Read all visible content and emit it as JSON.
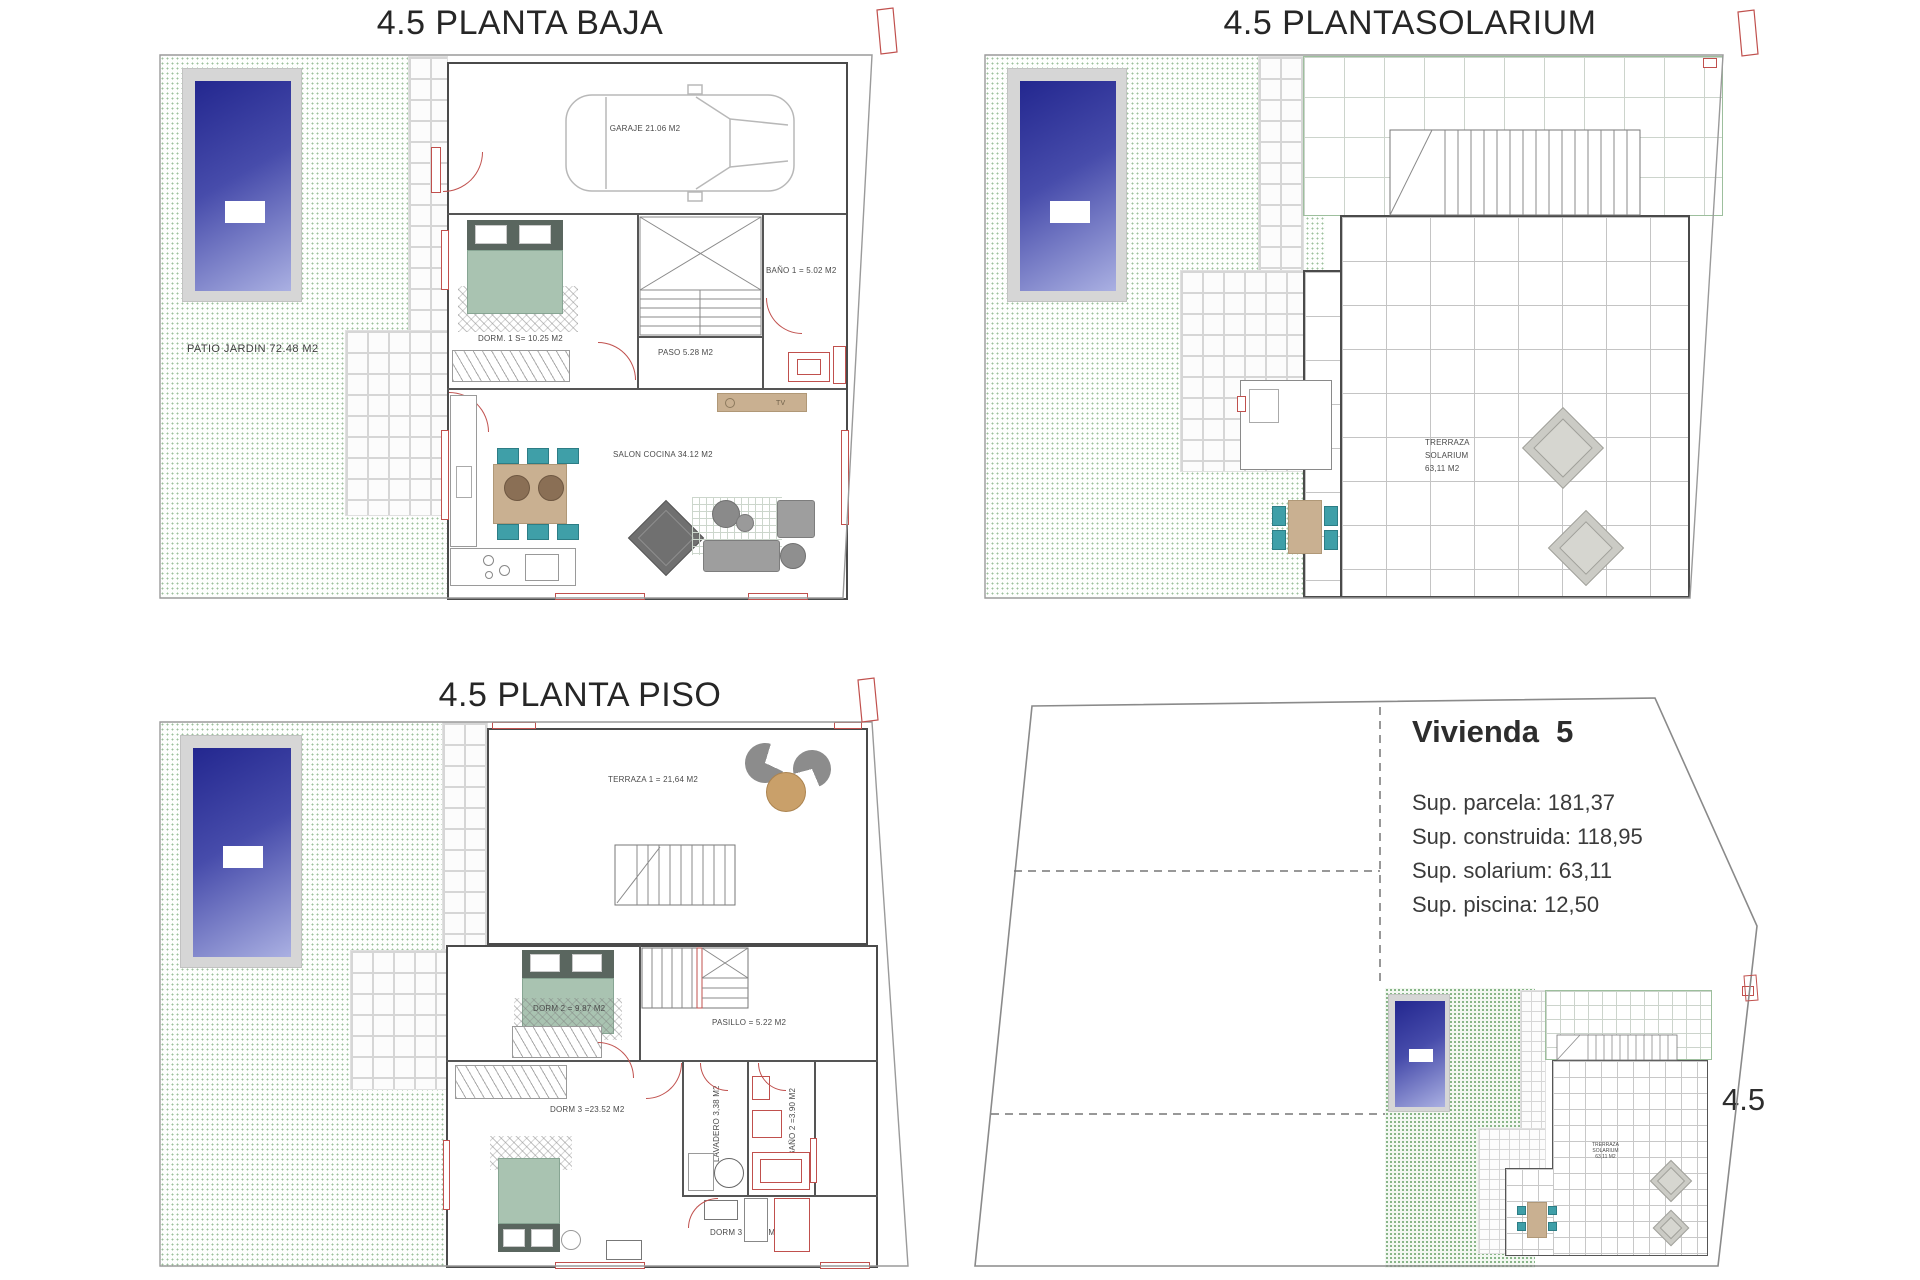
{
  "planta_baja": {
    "title": "4.5 PLANTA BAJA",
    "patio_label": "PATIO JARDIN 72.48 M2",
    "garaje_label": "GARAJE 21.06 M2",
    "dorm1_label": "DORM. 1 S= 10.25 M2",
    "bano1_label": "BAÑO 1 = 5.02 M2",
    "paso_label": "PASO 5.28 M2",
    "salon_label": "SALON COCINA 34.12 M2",
    "tv_label": "TV"
  },
  "planta_solarium": {
    "title": "4.5 PLANTASOLARIUM",
    "terraza_l1": "TRERRAZA",
    "terraza_l2": "SOLARIUM",
    "terraza_l3": "63,11 M2"
  },
  "planta_piso": {
    "title": "4.5 PLANTA PISO",
    "terraza1_label": "TERRAZA 1 = 21,64 M2",
    "dorm2_label": "DORM 2 = 9.87 M2",
    "pasillo_label": "PASILLO = 5.22 M2",
    "dorm3_label": "DORM 3 =23.52 M2",
    "lavadero_label": "LAVADERO 3,38 M2",
    "bano2_label": "BAÑO 2 =3.90 M2",
    "dorm3b_label": "DORM 3 =3.27 M2"
  },
  "vivienda": {
    "title": "Vivienda  5",
    "sup_parcela": "Sup. parcela: 181,37",
    "sup_construida": "Sup. construida: 118,95",
    "sup_solarium": "Sup. solarium: 63,11",
    "sup_piscina": "Sup. piscina: 12,50",
    "plot_label": "4.5",
    "mini_terraza_l1": "TRERRAZA",
    "mini_terraza_l2": "SOLARIUM",
    "mini_terraza_l3": "63,11 M2"
  },
  "colors": {
    "pool_dark": "#23278f",
    "pool_light": "#aab0e2",
    "deck_gray": "#d6d6d6",
    "garden_dot": "#9cc09c",
    "wall": "#4a4a4a",
    "door_red": "#c0504d",
    "bed_green": "#a9c3b1",
    "chair_teal": "#3f9fa8",
    "wood_tan": "#c9b091",
    "sofa_gray": "#9e9e9e"
  }
}
